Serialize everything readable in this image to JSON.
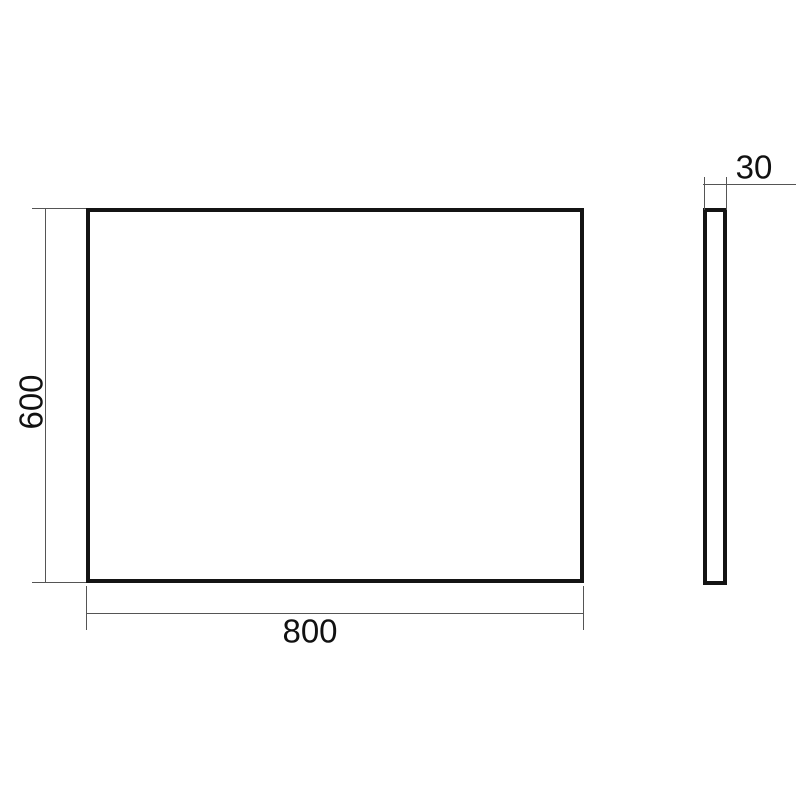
{
  "drawing": {
    "front_view": {
      "width_label": "800",
      "height_label": "600"
    },
    "side_view": {
      "depth_label": "30"
    }
  },
  "colors": {
    "background": "#ffffff",
    "outline": "#141414",
    "dimension_line": "#555555",
    "text": "#111111"
  }
}
